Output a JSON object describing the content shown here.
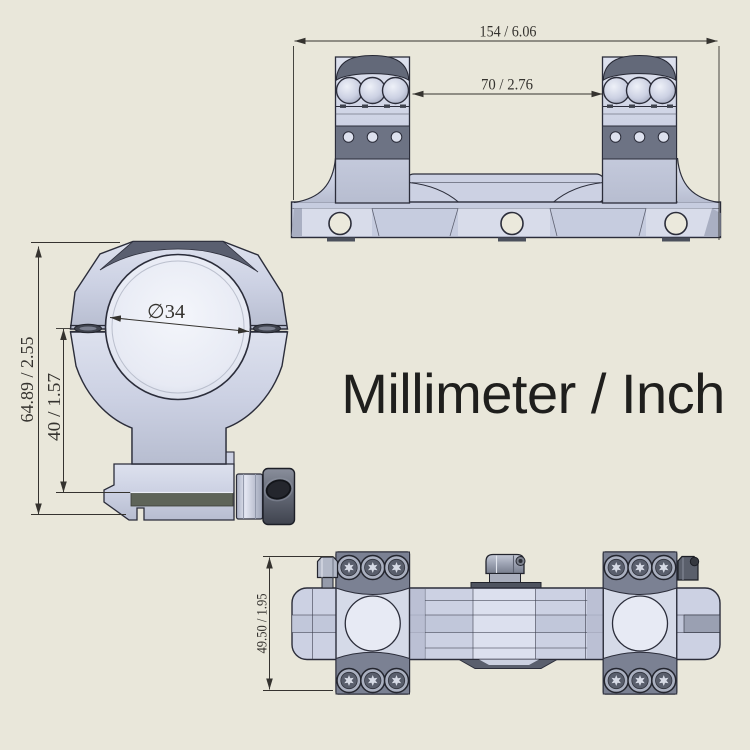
{
  "title": "Millimeter / Inch",
  "views": {
    "side_profile": {
      "dimensions": {
        "overall_length": "154 / 6.06",
        "ring_spacing": "70 / 2.76"
      }
    },
    "front_ring": {
      "dimensions": {
        "overall_height": "64.89 / 2.55",
        "center_height": "40 / 1.57",
        "ring_bore_diameter": "∅34"
      }
    },
    "top_plan": {
      "dimensions": {
        "overall_width": "49.50 / 1.95"
      }
    }
  },
  "colors": {
    "background": "#E9E7DA",
    "metal_light": "#CDD2E3",
    "metal_highlight": "#E7EAF4",
    "metal_mid": "#B9BFD2",
    "metal_dark": "#7C8294",
    "hardware_dark": "#575C69",
    "outline": "#2B2D3A",
    "dimension_ink": "#35332F",
    "title_ink": "#1F1F1D"
  }
}
